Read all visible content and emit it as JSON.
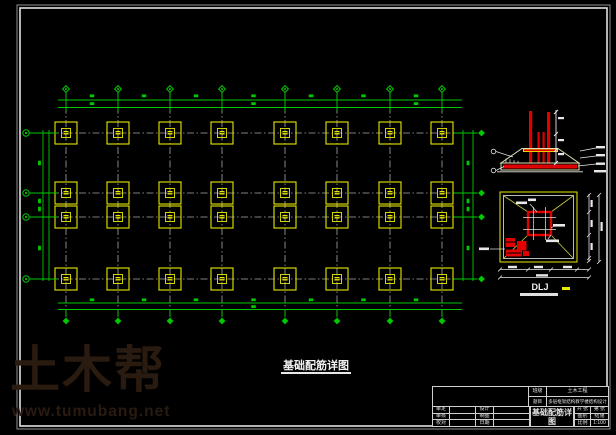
{
  "watermark": {
    "brand": "土木帮",
    "url": "www.tumubang.net"
  },
  "plan_title": "基础配筋详图",
  "detail_plan_label": "DLJ",
  "titleblock": {
    "class_label": "班级",
    "class_value": "土木工程",
    "topic_label": "题目",
    "topic_value": "多层框架结构教学楼结构设计",
    "approve_label": "审定",
    "check_label": "审核",
    "proof_label": "校对",
    "design_label": "设计",
    "draft_label": "制图",
    "date_label": "日期",
    "drawing_title": "基础配筋详图",
    "sheets_label": "共 张",
    "page_label": "第 张",
    "category_label": "图别",
    "category_value": "结施",
    "scale_label": "比例",
    "scale_value": "1:100"
  },
  "colors": {
    "green": "#00c800",
    "yellow": "#e8e800",
    "red": "#e00000",
    "grid_gray": "#a8a8a8",
    "frame_gray": "#8f8f8f",
    "frame_white": "#e2e2e2",
    "pale": "#dedeb0",
    "white": "#e8e8e8",
    "watermark_brown": "#2a1b10"
  }
}
